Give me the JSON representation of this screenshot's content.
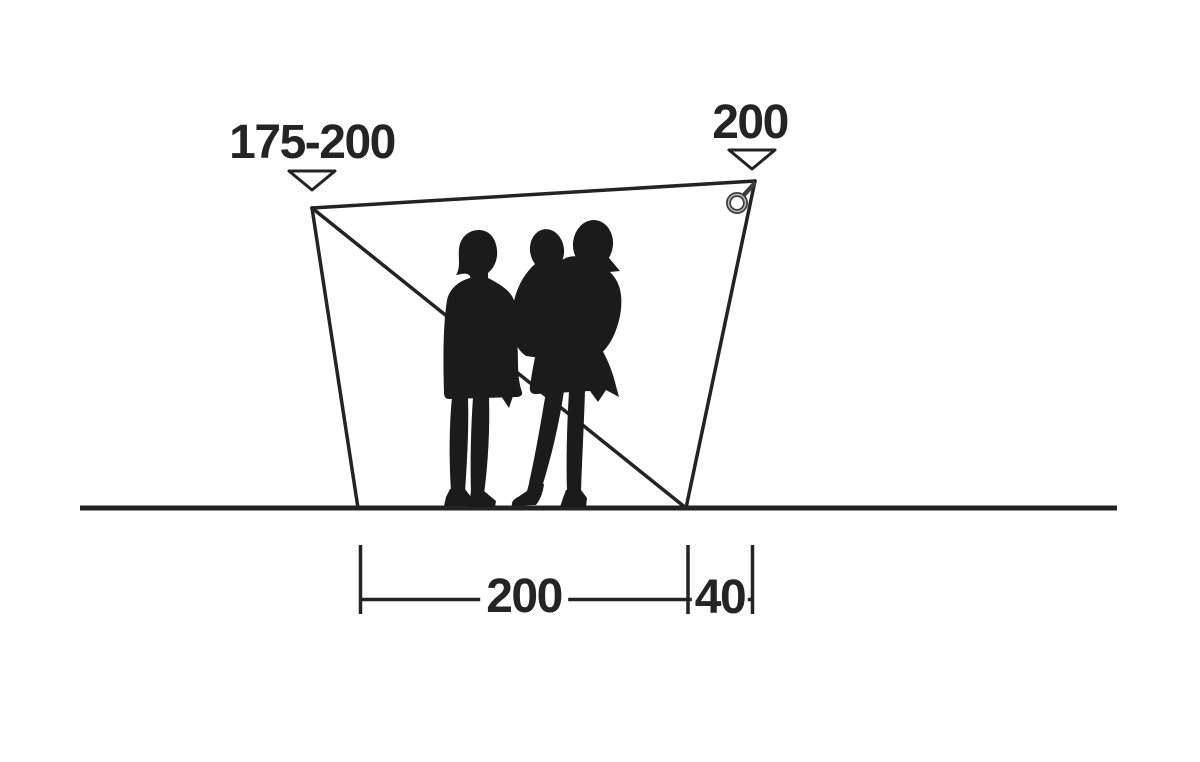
{
  "diagram": {
    "kind": "product-dimension-diagram",
    "subject": "tent-canopy-side-profile-with-people-for-scale",
    "dimensions": {
      "peak_left": {
        "label": "175-200",
        "position": "top-left"
      },
      "peak_right": {
        "label": "200",
        "position": "top-right"
      },
      "floor_width": {
        "label": "200",
        "position": "bottom-center"
      },
      "overhang": {
        "label": "40",
        "position": "bottom-right"
      }
    },
    "figures": {
      "left": "adult-silhouette",
      "right": "adult-carrying-child-silhouette"
    },
    "icons": {
      "corner_ring": "tie-out-ring-icon",
      "pointer_left": "triangle-down-marker",
      "pointer_right": "triangle-down-marker"
    },
    "colors": {
      "line": "#232323",
      "silhouette": "#1b1b1b",
      "text": "#242424",
      "ring_gray": "#3d3d3d",
      "background": "#ffffff"
    }
  }
}
